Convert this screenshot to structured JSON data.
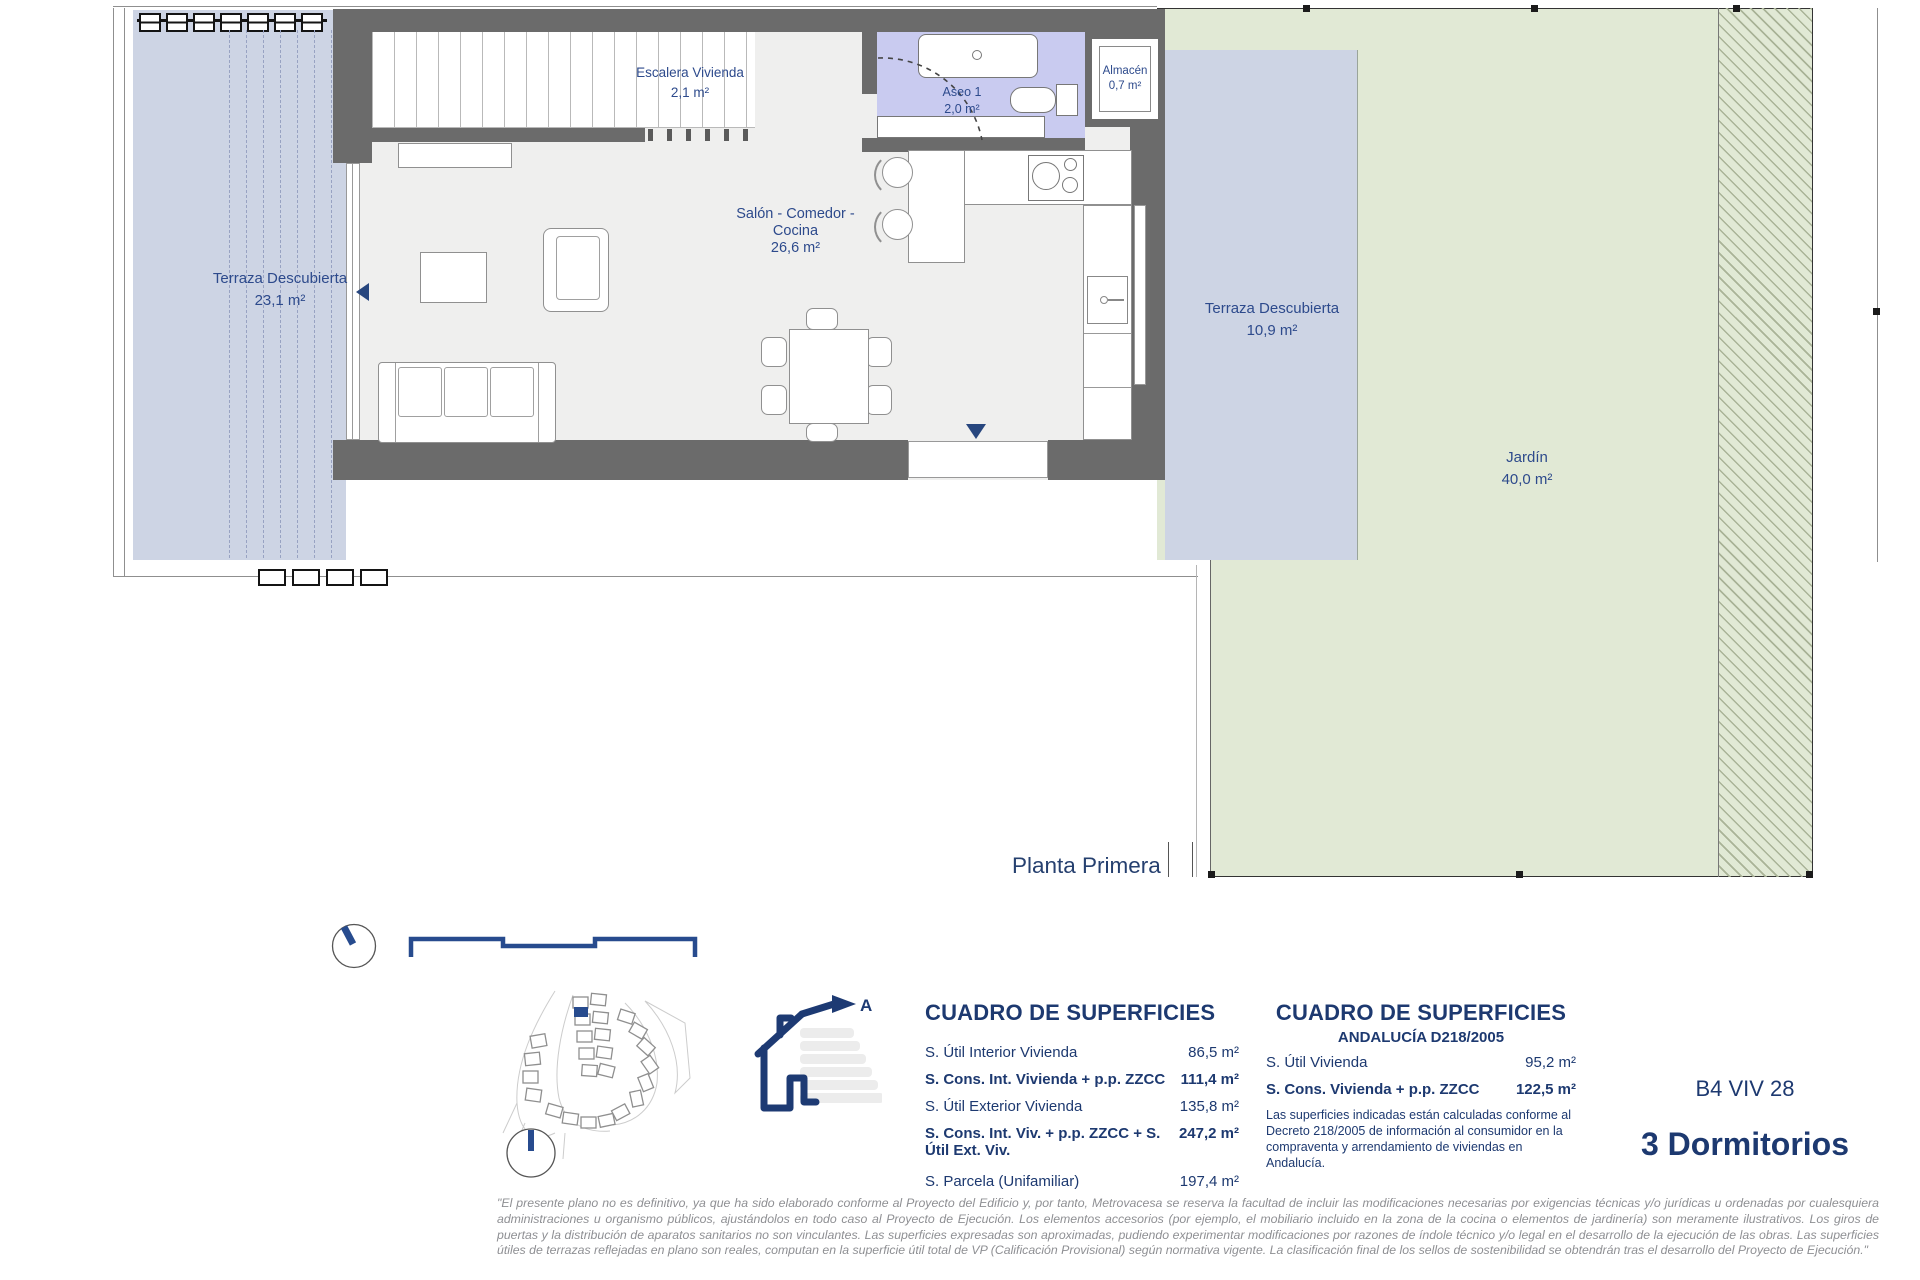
{
  "page": {
    "plan_title": "Planta Primera",
    "unit_code": "B4 VIV 28",
    "unit_type": "3 Dormitorios"
  },
  "rooms": {
    "terraza_izquierda": {
      "label": "Terraza Descubierta",
      "area": "23,1 m²"
    },
    "escalera": {
      "label": "Escalera Vivienda",
      "area": "2,1 m²"
    },
    "aseo": {
      "label": "Aseo 1",
      "area": "2,0 m²"
    },
    "almacen": {
      "label": "Almacén",
      "area": "0,7 m²"
    },
    "salon": {
      "line1": "Salón - Comedor -",
      "line2": "Cocina",
      "area": "26,6 m²"
    },
    "terraza_derecha": {
      "label": "Terraza Descubierta",
      "area": "10,9 m²"
    },
    "jardin": {
      "label": "Jardín",
      "area": "40,0 m²"
    }
  },
  "surface_table": {
    "title": "CUADRO DE SUPERFICIES",
    "rows": [
      {
        "label": "S. Útil Interior Vivienda",
        "value": "86,5 m²"
      },
      {
        "label": "S. Cons. Int. Vivienda + p.p. ZZCC",
        "value": "111,4 m²"
      },
      {
        "label": "S. Útil Exterior Vivienda",
        "value": "135,8 m²"
      },
      {
        "label": "S. Cons. Int. Viv. + p.p. ZZCC + S. Útil Ext. Viv.",
        "value": "247,2 m²"
      },
      {
        "label": "S. Parcela (Unifamiliar)",
        "value": "197,4 m²"
      }
    ]
  },
  "surface_table_andalucia": {
    "title": "CUADRO DE SUPERFICIES",
    "subtitle": "ANDALUCÍA D218/2005",
    "rows": [
      {
        "label": "S. Útil Vivienda",
        "value": "95,2 m²"
      },
      {
        "label": "S. Cons. Vivienda + p.p. ZZCC",
        "value": "122,5 m²"
      }
    ],
    "note": "Las superficies indicadas están calculadas conforme al Decreto 218/2005 de información al consumidor en la compraventa y arrendamiento de viviendas en Andalucía."
  },
  "energy_label": {
    "rating": "A"
  },
  "disclaimer": "\"El presente plano no es definitivo, ya que ha sido elaborado conforme al Proyecto del Edificio y, por tanto, Metrovacesa se reserva la facultad de incluir las modificaciones necesarias por exigencias técnicas y/o jurídicas u ordenadas por cualesquiera administraciones u organismo públicos, ajustándolos en todo caso al Proyecto de Ejecución. Los elementos accesorios (por ejemplo, el mobiliario incluido en la zona de la cocina o elementos de jardinería) son meramente ilustrativos. Los giros de puertas y la distribución de aparatos sanitarios no son vinculantes. Las superficies expresadas son aproximadas, pudiendo experimentar modificaciones por razones de índole técnico y/o legal en el desarrollo de la ejecución de las obras. Las superficies útiles de terrazas reflejadas en plano son reales, computan en la superficie útil total de VP (Calificación Provisional) según normativa vigente. La clasificación final de los sellos de sostenibilidad se obtendrán tras el desarrollo del Proyecto de Ejecución.\"",
  "colors": {
    "accent_navy": "#1d3970",
    "wall_gray": "#6b6b6b",
    "terrace_blue": "#cdd4e4",
    "aseo_lavender": "#c9cbf0",
    "garden_green": "#e1e9d5"
  }
}
